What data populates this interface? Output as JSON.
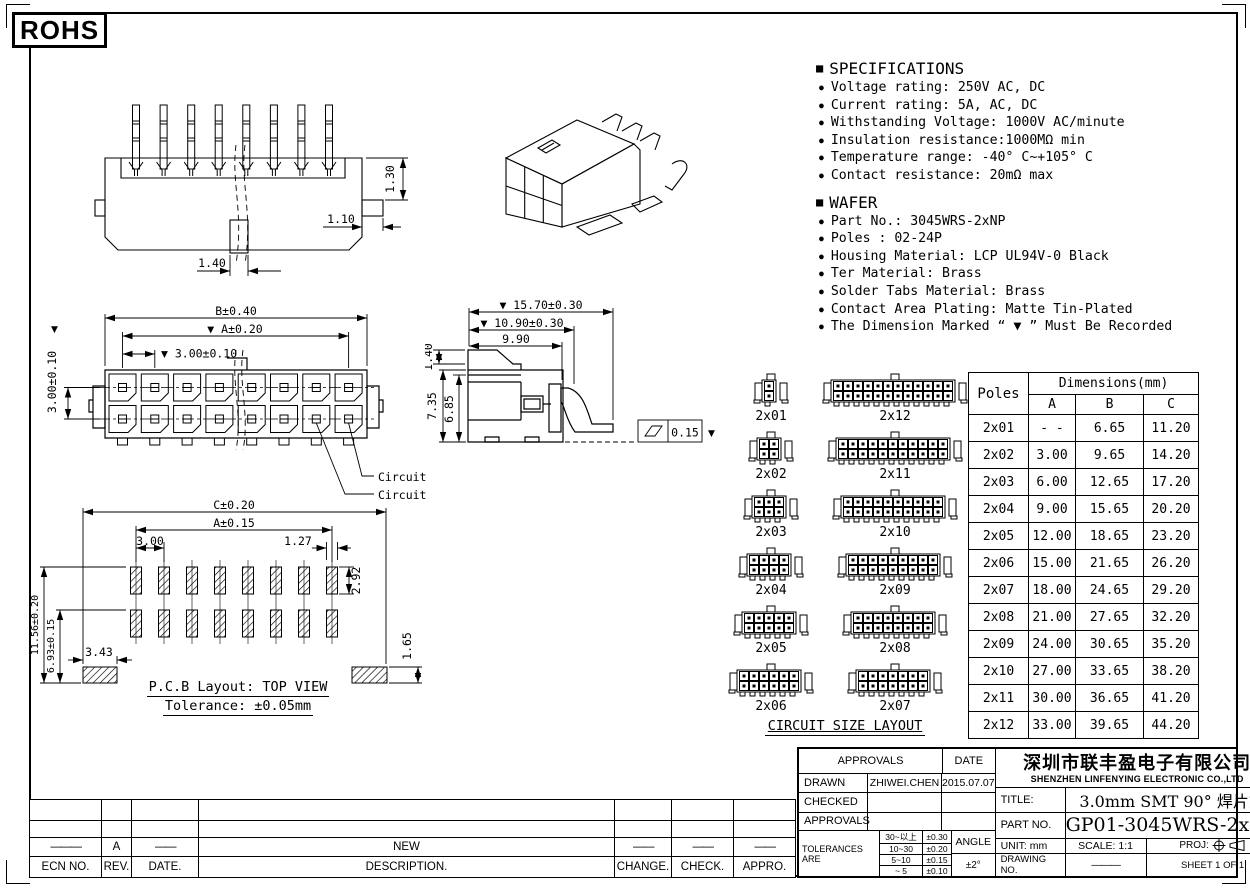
{
  "page": {
    "rohs": "ROHS"
  },
  "specifications": {
    "bullet": "■",
    "item_bullet": "●",
    "title": "SPECIFICATIONS",
    "items": [
      "Voltage rating: 250V AC, DC",
      "Current rating: 5A, AC, DC",
      "Withstanding Voltage: 1000V AC/minute",
      "Insulation resistance:1000MΩ min",
      "Temperature range: -40° C~+105° C",
      "Contact resistance: 20mΩ max"
    ]
  },
  "wafer": {
    "bullet": "■",
    "item_bullet": "●",
    "title": "WAFER",
    "items": [
      "Part No.: 3045WRS-2xNP",
      "Poles : 02-24P",
      "Housing Material: LCP UL94V-0 Black",
      "Ter Material: Brass",
      "Solder Tabs Material: Brass",
      "Contact Area Plating: Matte Tin-Plated",
      "The Dimension Marked “ ▼ ” Must Be Recorded"
    ]
  },
  "drawings": {
    "side_top": {
      "dim_130": "1.30",
      "dim_110": "1.10",
      "dim_140": "1.40"
    },
    "front": {
      "dim_b": "B±0.40",
      "dim_a": "▼ A±0.20",
      "dim_pitch": "▼ 3.00±0.10",
      "dim_row_marker": "▼",
      "dim_row": "3.00±0.10",
      "circuit1": "Circuit 1",
      "circuit2": "Circuit 2"
    },
    "side": {
      "dim_1570": "▼ 15.70±0.30",
      "dim_1090": "▼ 10.90±0.30",
      "dim_990": "9.90",
      "dim_140": "1.40",
      "dim_735": "7.35",
      "dim_685": "6.85",
      "flatness": "0.15",
      "flat_marker": "▼"
    },
    "pcb": {
      "dim_c": "C±0.20",
      "dim_a": "A±0.15",
      "dim_300": "3.00",
      "dim_127": "1.27",
      "dim_292": "2.92",
      "dim_1156": "11.56±0.20",
      "dim_693": "6.93±0.15",
      "dim_343": "3.43",
      "dim_165": "1.65",
      "caption1": "P.C.B Layout: TOP VIEW",
      "caption2": "Tolerance: ±0.05mm"
    }
  },
  "circuit_layout": {
    "title": "CIRCUIT SIZE LAYOUT",
    "pairs": [
      {
        "left": {
          "label": "2x01",
          "n": 1
        },
        "right": {
          "label": "2x12",
          "n": 12
        }
      },
      {
        "left": {
          "label": "2x02",
          "n": 2
        },
        "right": {
          "label": "2x11",
          "n": 11
        }
      },
      {
        "left": {
          "label": "2x03",
          "n": 3
        },
        "right": {
          "label": "2x10",
          "n": 10
        }
      },
      {
        "left": {
          "label": "2x04",
          "n": 4
        },
        "right": {
          "label": "2x09",
          "n": 9
        }
      },
      {
        "left": {
          "label": "2x05",
          "n": 5
        },
        "right": {
          "label": "2x08",
          "n": 8
        }
      },
      {
        "left": {
          "label": "2x06",
          "n": 6
        },
        "right": {
          "label": "2x07",
          "n": 7
        }
      }
    ]
  },
  "poles_table": {
    "col_poles": "Poles",
    "col_dims": "Dimensions(mm)",
    "cols": [
      "A",
      "B",
      "C"
    ],
    "rows": [
      [
        "2x01",
        "- -",
        "6.65",
        "11.20"
      ],
      [
        "2x02",
        "3.00",
        "9.65",
        "14.20"
      ],
      [
        "2x03",
        "6.00",
        "12.65",
        "17.20"
      ],
      [
        "2x04",
        "9.00",
        "15.65",
        "20.20"
      ],
      [
        "2x05",
        "12.00",
        "18.65",
        "23.20"
      ],
      [
        "2x06",
        "15.00",
        "21.65",
        "26.20"
      ],
      [
        "2x07",
        "18.00",
        "24.65",
        "29.20"
      ],
      [
        "2x08",
        "21.00",
        "27.65",
        "32.20"
      ],
      [
        "2x09",
        "24.00",
        "30.65",
        "35.20"
      ],
      [
        "2x10",
        "27.00",
        "33.65",
        "38.20"
      ],
      [
        "2x11",
        "30.00",
        "36.65",
        "41.20"
      ],
      [
        "2x12",
        "33.00",
        "39.65",
        "44.20"
      ]
    ]
  },
  "title_block": {
    "approvals_header": "APPROVALS",
    "date_header": "DATE",
    "drawn_label": "DRAWN",
    "drawn_name": "ZHIWEI.CHEN",
    "drawn_date": "2015.07.07",
    "checked_label": "CHECKED",
    "approvals_label": "APPROVALS",
    "tolerances_label": "TOLERANCES ARE",
    "tolerances": [
      [
        "30~以上",
        "±0.30"
      ],
      [
        "10~30",
        "±0.20"
      ],
      [
        "5~10",
        "±0.15"
      ],
      [
        "~ 5",
        "±0.10"
      ]
    ],
    "angle_label": "ANGLE",
    "angle_value": "±2°",
    "company_cn": "深圳市联丰盈电子有限公司",
    "company_en": "SHENZHEN LINFENYING ELECTRONIC CO.,LTD",
    "title_label": "TITLE:",
    "title_value": "3.0mm SMT 90° 焊片式",
    "part_label": "PART NO.",
    "part_value": "GP01-3045WRS-2xNP",
    "unit_label": "UNIT: mm",
    "scale_label": "SCALE: 1:1",
    "proj_label": "PROJ:",
    "drawing_no_label": "DRAWING NO.",
    "drawing_no_value": "———",
    "sheet_label": "SHEET 1 OF 1"
  },
  "revision_table": {
    "rows": [
      [
        "",
        "",
        "",
        "",
        "",
        "",
        ""
      ],
      [
        "",
        "",
        "",
        "",
        "",
        "",
        ""
      ],
      [
        "———",
        "A",
        "——",
        "NEW",
        "——",
        "——",
        "——"
      ],
      [
        "ECN NO.",
        "REV.",
        "DATE.",
        "DESCRIPTION.",
        "CHANGE.",
        "CHECK.",
        "APPRO."
      ]
    ]
  }
}
